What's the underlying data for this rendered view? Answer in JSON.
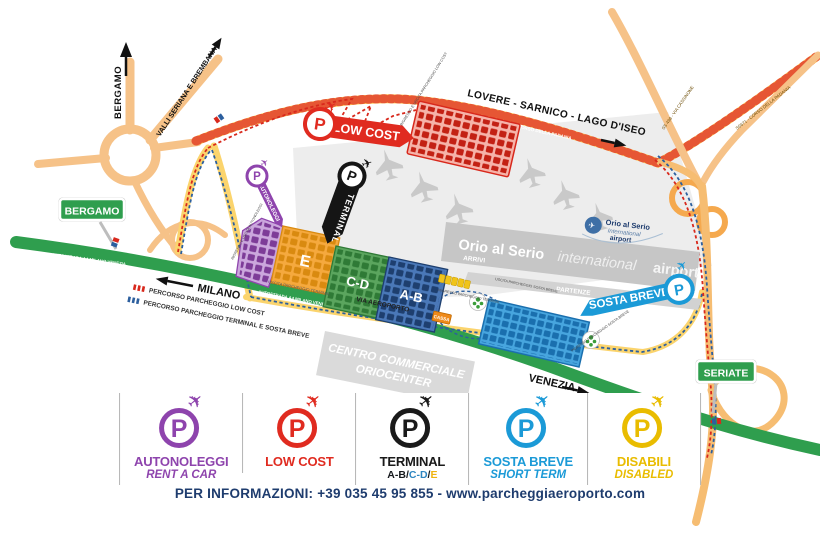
{
  "icons": {
    "p": "P",
    "plane": "✈"
  },
  "map": {
    "direction_labels": {
      "bergamo_up": "BERGAMO",
      "valli": "VALLI SERIANA E BREMBANA",
      "lovere": "LOVERE - SARNICO - LAGO D'ISEO",
      "milano": "MILANO",
      "venezia": "VENEZIA"
    },
    "city_signs": {
      "bergamo": "BERGAMO",
      "seriate": "SERIATE"
    },
    "road_labels": {
      "ss671": "SS671 - CORSO DELLA PADANIA",
      "ss671_right": "SS671 - CORSO DELLA PADANIA",
      "ss498": "SS 498 - VIA CASSINONE",
      "autostrada": "AUTOSTRADA A4 MILANO VENEZIA",
      "via_aeroporto": "VIA AEROPORTO",
      "uscita_terminal": "USCITA PARCHEGGIO TERMINAL"
    },
    "airport": {
      "name_bold": "Orio al Serio",
      "name_italic": "international",
      "name_end": "airport",
      "arrivi": "ARRIVI",
      "partenze": "PARTENZE",
      "logo": {
        "line1": "Orio al Serio",
        "line2": "International",
        "line3": "airport"
      }
    },
    "badges": {
      "low_cost": "LOW COST",
      "terminal": "TERMINAL",
      "sosta_breve": "SOSTA BREVE",
      "autonoleggi": "AUTONOLEGGI"
    },
    "lots": {
      "e": "E",
      "cd": "C-D",
      "ab": "A-B",
      "cassa": "CASSA"
    },
    "access_labels": {
      "lowcost": "INGRESSO E USCITA PARCHEGGIO LOW COST",
      "autonoleggi": "INGRESSO E USCITA AUTONOLEGGI",
      "terminal_in": "INGRESSO PARCHEGGIO TERMINAL",
      "sosta_out": "USCITA PARCHEGGIO SOSTA BREVE",
      "sosta_in": "INGRESSO PARCHEGGIO SOSTA BREVE"
    },
    "route_legend": {
      "low_cost": "PERCORSO PARCHEGGIO LOW COST",
      "terminal": "PERCORSO PARCHEGGIO TERMINAL E SOSTA BREVE"
    },
    "oriocenter": {
      "line1": "CENTRO COMMERCIALE",
      "line2": "ORIOCENTER"
    }
  },
  "legend": {
    "items": [
      {
        "title": "AUTONOLEGGI",
        "subtitle": "RENT A CAR",
        "color": "#8E44AD"
      },
      {
        "title": "LOW COST",
        "subtitle": "",
        "color": "#E02B20"
      },
      {
        "title": "TERMINAL",
        "subtitle": "",
        "color": "#1A1A1A",
        "parts": {
          "ab": "A-B",
          "s1": "/",
          "cd": "C-D",
          "s2": "/",
          "e": "E"
        }
      },
      {
        "title": "SOSTA BREVE",
        "subtitle": "SHORT TERM",
        "color": "#1B9AD7"
      },
      {
        "title": "DISABILI",
        "subtitle": "DISABLED",
        "color": "#E9BC00"
      }
    ]
  },
  "footer": {
    "info": "PER INFORMAZIONI: +39 035 45 95 855 - www.parcheggiaeroporto.com"
  },
  "palette": {
    "highway_green": "#2F9E4E",
    "road_yellow": "#FFC84D",
    "road_orange": "#F6C288",
    "route_red": "#D8281C",
    "route_blue": "#2C5F9E",
    "lot_red": "#E02B20",
    "lot_purple": "#8E44AD",
    "lot_orange": "#F5A93E",
    "lot_green": "#5BA55E",
    "lot_blue": "#4A78B8",
    "sosta_blue": "#1B9AD7",
    "disabled_yellow": "#F0C419",
    "apron_gray": "#EDEDED",
    "terminal_gray": "#C6C6C6"
  }
}
